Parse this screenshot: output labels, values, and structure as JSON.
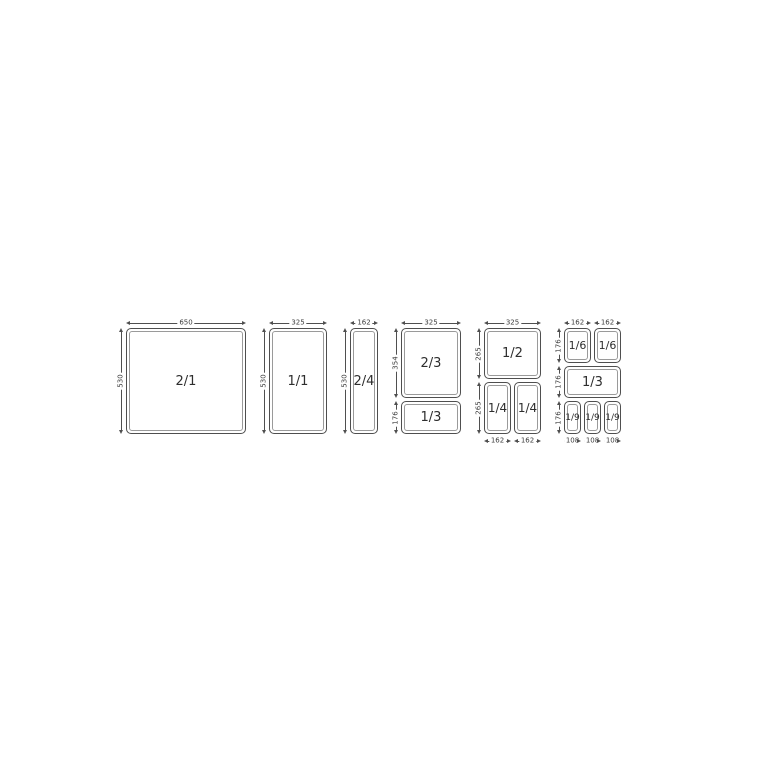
{
  "diagram": {
    "description_labels": [],
    "colors": {
      "line": "#4f4f4f",
      "inner_line": "#9a9a9a",
      "text": "#2e2e2e",
      "background": "#ffffff"
    },
    "groups": [
      {
        "id": "2/1",
        "top_dims": [
          "650"
        ],
        "left_dims": [
          "530"
        ],
        "pans": [
          "2/1"
        ]
      },
      {
        "id": "1/1",
        "top_dims": [
          "325"
        ],
        "left_dims": [
          "530"
        ],
        "pans": [
          "1/1"
        ]
      },
      {
        "id": "2/4",
        "top_dims": [
          "162"
        ],
        "left_dims": [
          "530"
        ],
        "pans": [
          "2/4"
        ]
      },
      {
        "id": "2/3 + 1/3",
        "top_dims": [
          "325"
        ],
        "left_dims": [
          "354",
          "176"
        ],
        "pans": [
          "2/3",
          "1/3"
        ]
      },
      {
        "id": "1/2 + 1/4 + 1/4",
        "top_dims": [
          "325"
        ],
        "left_dims": [
          "265",
          "265"
        ],
        "bottom_dims": [
          "162",
          "162"
        ],
        "pans": [
          "1/2",
          "1/4",
          "1/4"
        ]
      },
      {
        "id": "1/6 + 1/6 + 1/3 + 1/9 + 1/9 + 1/9",
        "top_dims": [
          "162",
          "162"
        ],
        "left_dims": [
          "176",
          "176",
          "176"
        ],
        "bottom_dims": [
          "108",
          "108",
          "108"
        ],
        "pans": [
          "1/6",
          "1/6",
          "1/3",
          "1/9",
          "1/9",
          "1/9"
        ]
      }
    ]
  }
}
